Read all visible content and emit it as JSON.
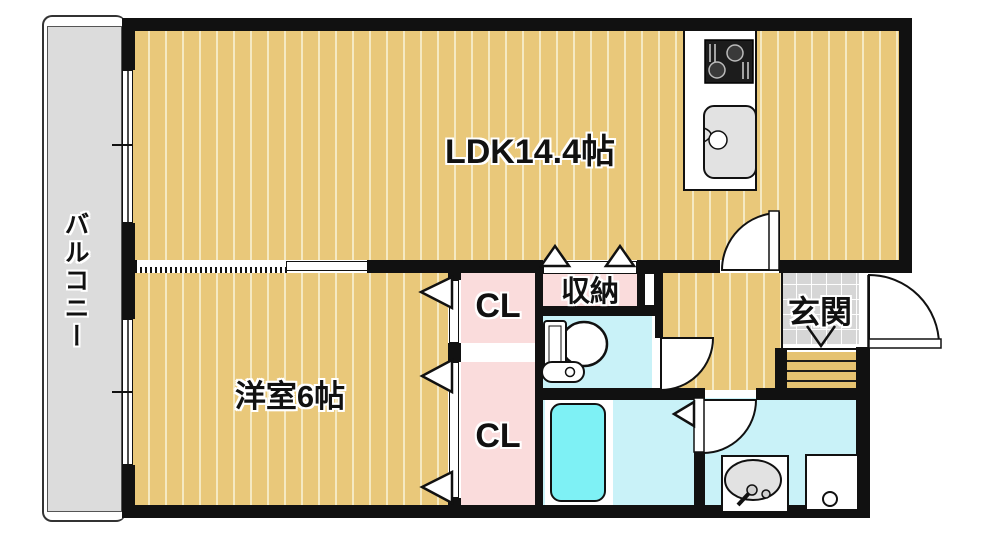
{
  "plan": {
    "type": "apartment-floorplan",
    "labels": {
      "balcony": "バルコニー",
      "ldk": "LDK14.4帖",
      "western_room": "洋室6帖",
      "closet_upper": "CL",
      "closet_lower": "CL",
      "storage": "収納",
      "entrance": "玄関"
    },
    "fixtures": [
      "kitchen-stove",
      "kitchen-sink",
      "toilet",
      "bathtub",
      "wash-basin",
      "washing-machine-pan",
      "entrance-step"
    ],
    "doors": [
      "ldk-hinged-door",
      "toilet-hinged-door",
      "washroom-hinged-door",
      "entrance-hinged-door",
      "bathroom-folding-door",
      "closet-folding-doors",
      "storage-folding-door",
      "ldk-sliding-door"
    ],
    "colors": {
      "wall": "#111111",
      "wood_floor": "#e9c87a",
      "wood_stripe": "#f5e9c2",
      "closet_pink": "#fadcdc",
      "wet_cyan": "#c9f2f8",
      "bathtub_cyan": "#7ef1f5",
      "tile_gray": "#d6d6d6",
      "step_tan": "#e5c271",
      "balcony_gray": "#dcdcdc",
      "text": "#111111"
    }
  }
}
